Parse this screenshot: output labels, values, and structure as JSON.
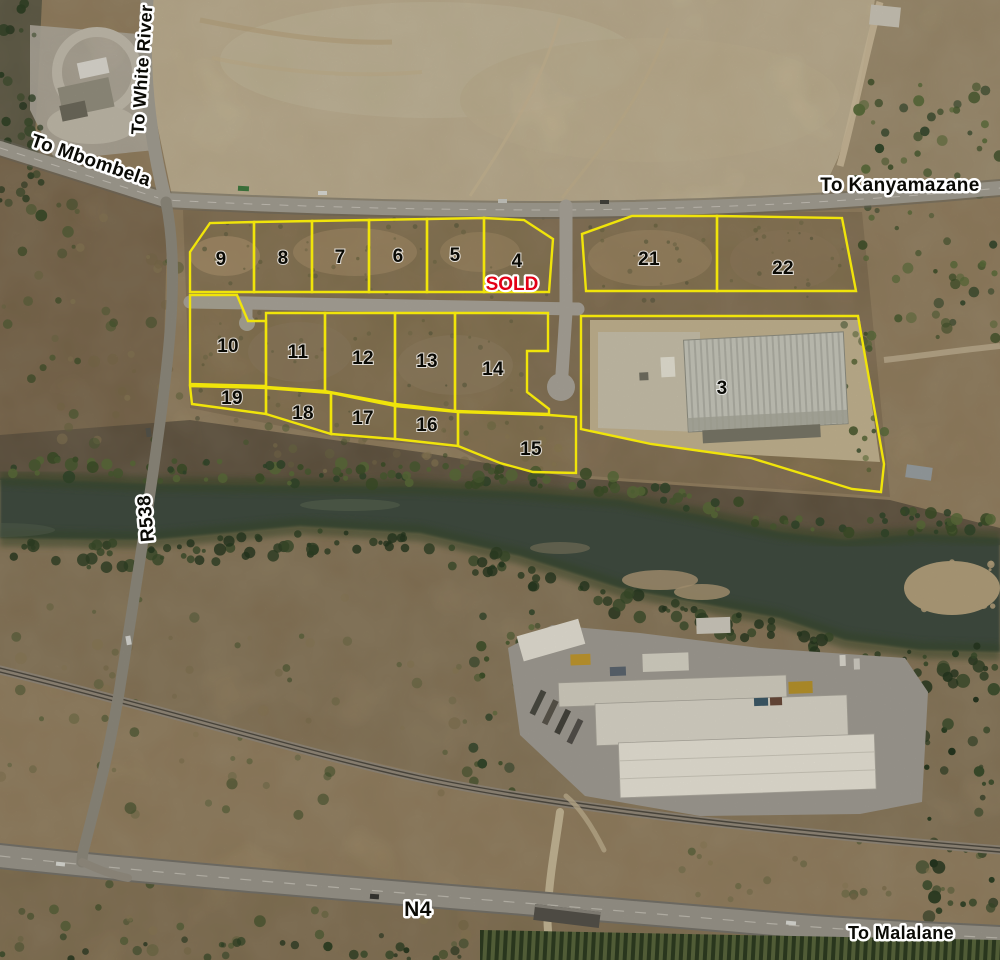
{
  "map": {
    "road_labels": {
      "white_river": "To White River",
      "mbombela": "To Mbombela",
      "kanyamazane": "To Kanyamazane",
      "r538": "R538",
      "n4": "N4",
      "malalane": "To Malalane"
    },
    "plots": [
      {
        "number": "9"
      },
      {
        "number": "8"
      },
      {
        "number": "7"
      },
      {
        "number": "6"
      },
      {
        "number": "5"
      },
      {
        "number": "4",
        "status": "SOLD"
      },
      {
        "number": "21"
      },
      {
        "number": "22"
      },
      {
        "number": "10"
      },
      {
        "number": "11"
      },
      {
        "number": "12"
      },
      {
        "number": "13"
      },
      {
        "number": "14"
      },
      {
        "number": "19"
      },
      {
        "number": "18"
      },
      {
        "number": "17"
      },
      {
        "number": "16"
      },
      {
        "number": "15"
      },
      {
        "number": "3"
      }
    ],
    "sold_label": "SOLD",
    "colors": {
      "plot_boundary": "#f0e40a",
      "sold_text": "#e30016",
      "label_text": "#0a0a05",
      "label_halo": "#ffffff"
    }
  }
}
